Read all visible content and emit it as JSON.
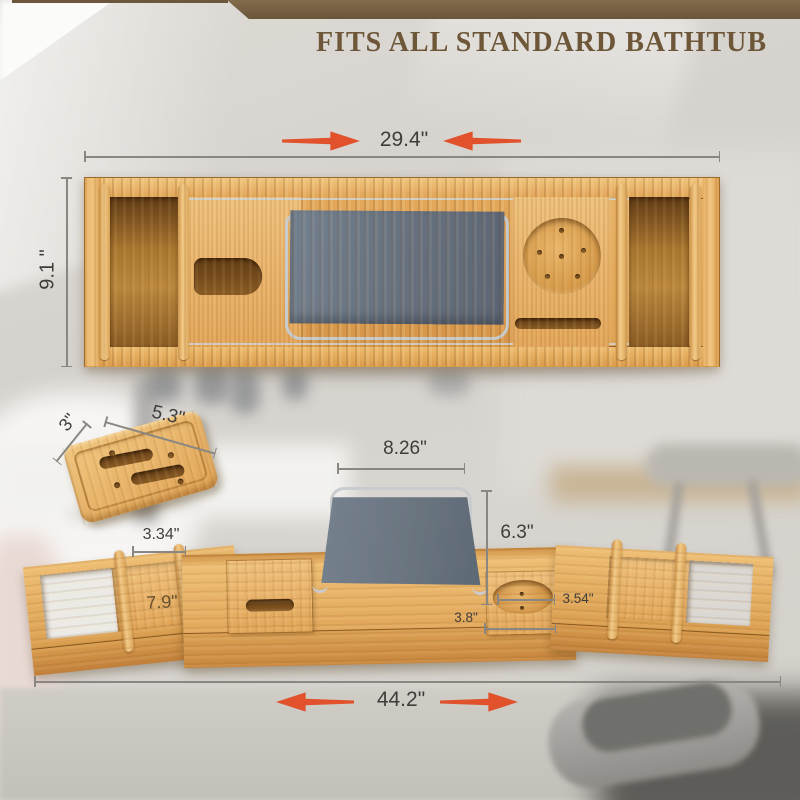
{
  "header": {
    "title": "FITS ALL STANDARD BATHTUB"
  },
  "dims": {
    "top_width": "29.4\"",
    "top_depth": "9.1 \"",
    "dish_length": "5.3\"",
    "dish_width": "3\"",
    "stand_width": "8.26\"",
    "stand_height": "6.3\"",
    "rail_gap": "3.34\"",
    "tray_inner": "7.9\"",
    "cup_width": "3.8\"",
    "cup_diameter": "3.54\"",
    "extended_width": "44.2\""
  },
  "colors": {
    "arrow_accent": "#e0512c",
    "banner_brown": "#77603f",
    "title_text": "#6e5638",
    "bamboo": "#e4aa5c",
    "fabric_gray": "#6b7686"
  },
  "icons": {
    "width_arrows": "red tapered double arrows"
  }
}
